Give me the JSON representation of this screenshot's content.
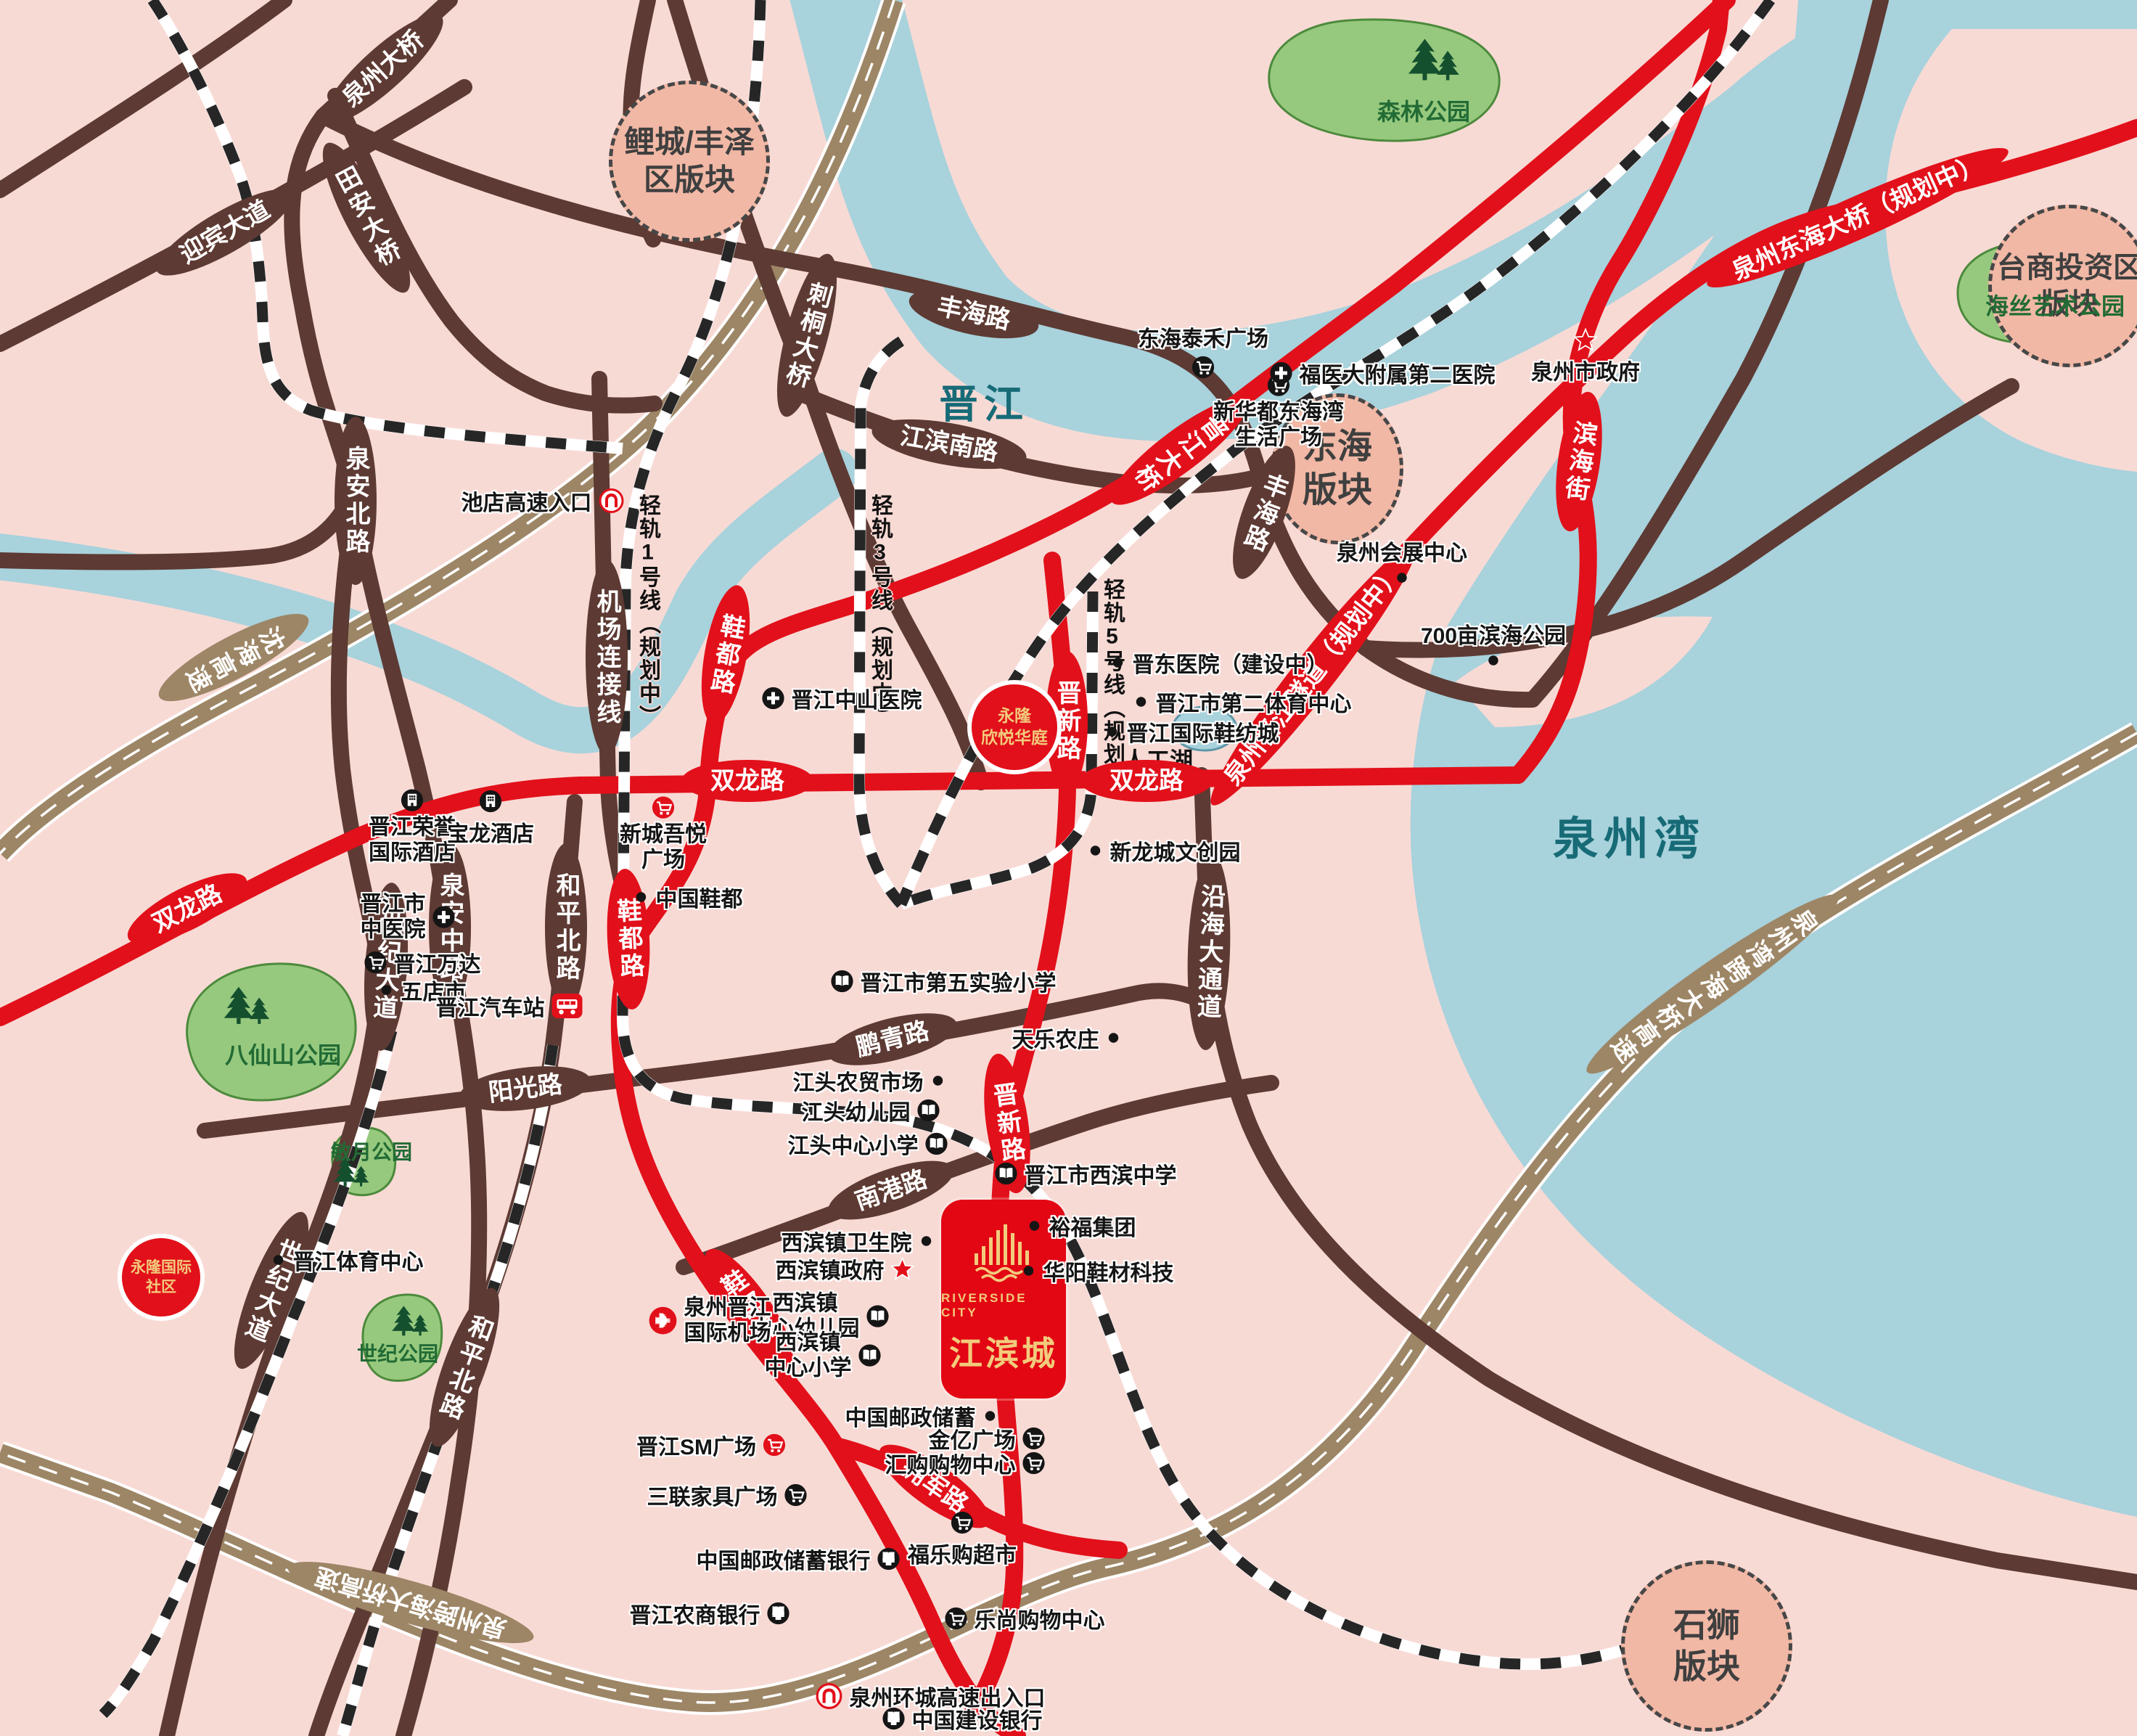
{
  "project": {
    "name_en": "RIVERSIDE CITY",
    "name_zh": "江滨城"
  },
  "colors": {
    "red": "#e2101a",
    "brown": "#5d3a33",
    "tan": "#9d8666",
    "water": "#a8d2dc",
    "background_pink": "#f8dad5",
    "zone_fill": "#f1b8a5",
    "park_fill": "#96c97e",
    "gold": "#f2cb7c"
  },
  "zones": {
    "licheng": {
      "line1": "鲤城/丰泽",
      "line2": "区版块"
    },
    "donghai": {
      "line1": "东海",
      "line2": "版块"
    },
    "taishang": {
      "line1": "台商投资区",
      "line2": "版块"
    },
    "shishi": {
      "line1": "石狮",
      "line2": "版块"
    }
  },
  "waters": {
    "jinjiang_river": "晋江",
    "quanzhou_bay": "泉州湾",
    "artificial_lake": "人工湖"
  },
  "parks": {
    "forest": "森林公园",
    "haisi_art": "海丝艺术公园",
    "baxianshan": "八仙山公园",
    "minyue": "敏月公园",
    "century": "世纪公园"
  },
  "rails": {
    "line1": "轻轨1号线（规划中）",
    "line3": "轻轨3号线（规划中）",
    "line5": "轻轨5号线（规划中）"
  },
  "roads": {
    "quanzhou_bridge": "泉州大桥",
    "tianan_bridge": "田安大桥",
    "yingbin_avenue": "迎宾大道",
    "citong_bridge": "刺桐大桥",
    "fenghai_road": "丰海路",
    "jiangbin_south_road": "江滨南路",
    "jinjiang_bridge": "晋江大桥",
    "binhai_street": "滨海街",
    "donghai_bridge": "泉州东海大桥（规划中）",
    "tunnel": "泉州晋江隧道（规划中）",
    "quanan_north_road": "泉安北路",
    "airport_link": "机场连接线",
    "shenhai_expressway": "沈海高速",
    "shuanglong_road": "双龙路",
    "xiedu_road": "鞋都路",
    "jinxin_road": "晋新路",
    "quanan_middle_road": "泉安中路",
    "heping_north_road": "和平北路",
    "century_avenue": "世纪大道",
    "yangguang_road": "阳光路",
    "pengqing_road": "鹏青路",
    "nangang_road": "南港路",
    "yanhai_avenue": "沿海大通道",
    "yongjun_road": "拥军路",
    "bay_bridge_expressway": "泉州湾跨海大桥高速",
    "cross_sea_expressway": "泉州跨海大桥高速"
  },
  "spots": {
    "yonglong_xinyue": {
      "line1": "永隆",
      "line2": "欣悦华庭"
    },
    "yonglong_intl": {
      "line1": "永隆国际",
      "line2": "社区"
    }
  },
  "pois": {
    "donghai_taihe": {
      "label": "东海泰禾广场",
      "icon": "cart-icon"
    },
    "xinhuadu": {
      "label": "新华都东海湾",
      "label2": "生活广场",
      "icon": "cart-icon"
    },
    "fuyida_hospital": {
      "label": "福医大附属第二医院",
      "icon": "hospital-icon"
    },
    "quanzhou_gov": {
      "label": "泉州市政府",
      "icon": "star-icon"
    },
    "convention_center": {
      "label": "泉州会展中心",
      "icon": "dot-icon"
    },
    "binhai_park700": {
      "label": "700亩滨海公园",
      "icon": "dot-icon"
    },
    "jindong_hospital": {
      "label": "晋东医院（建设中）",
      "icon": "dot-icon"
    },
    "second_sports": {
      "label": "晋江市第二体育中心",
      "icon": "dot-icon"
    },
    "shoe_textile_city": {
      "label": "晋江国际鞋纺城",
      "icon": "dot-icon"
    },
    "xinlongcheng": {
      "label": "新龙城文创园",
      "icon": "dot-icon"
    },
    "zhongshan_hospital": {
      "label": "晋江中山医院",
      "icon": "hospital-icon"
    },
    "rongyu_hotel": {
      "label": "晋江荣誉",
      "label2": "国际酒店",
      "icon": "hotel-icon"
    },
    "baolong_hotel": {
      "label": "宝龙酒店",
      "icon": "hotel-icon"
    },
    "wuyue_plaza": {
      "label": "新城吾悦",
      "label2": "广场",
      "icon": "cart-red-icon"
    },
    "china_shoe_capital": {
      "label": "中国鞋都",
      "icon": "dot-icon"
    },
    "tcm_hospital": {
      "label": "晋江市",
      "label2": "中医院",
      "icon": "hospital-icon"
    },
    "jinjiang_wanda": {
      "label": "晋江万达",
      "icon": "cart-icon"
    },
    "wudianshi": {
      "label": "五店市",
      "icon": "dot-icon"
    },
    "bus_station": {
      "label": "晋江汽车站",
      "icon": "bus-icon"
    },
    "sports_center": {
      "label": "晋江体育中心",
      "icon": "dot-icon"
    },
    "fifth_school": {
      "label": "晋江市第五实验小学",
      "icon": "school-icon"
    },
    "tianle_farm": {
      "label": "天乐农庄",
      "icon": "dot-icon"
    },
    "jiangtou_market": {
      "label": "江头农贸市场",
      "icon": "dot-icon"
    },
    "jiangtou_kindergarten": {
      "label": "江头幼儿园",
      "icon": "school-icon"
    },
    "jiangtou_primary": {
      "label": "江头中心小学",
      "icon": "school-icon"
    },
    "xibin_middle": {
      "label": "晋江市西滨中学",
      "icon": "school-icon"
    },
    "yufu_group": {
      "label": "裕福集团",
      "icon": "dot-icon"
    },
    "huayang_tech": {
      "label": "华阳鞋材科技",
      "icon": "dot-icon"
    },
    "xibin_clinic": {
      "label": "西滨镇卫生院",
      "icon": "dot-icon"
    },
    "xibin_gov": {
      "label": "西滨镇政府",
      "icon": "star-icon"
    },
    "xibin_kindergarten": {
      "label": "西滨镇",
      "label2": "中心幼儿园",
      "icon": "school-icon"
    },
    "xibin_primary": {
      "label": "西滨镇",
      "label2": "中心小学",
      "icon": "school-icon"
    },
    "airport": {
      "label": "泉州晋江",
      "label2": "国际机场",
      "icon": "airport-icon"
    },
    "sm_plaza": {
      "label": "晋江SM广场",
      "icon": "cart-red-icon"
    },
    "sanlian_furniture": {
      "label": "三联家具广场",
      "icon": "cart-icon"
    },
    "postal_savings": {
      "label": "中国邮政储蓄",
      "icon": "dot-icon"
    },
    "jinyi_plaza": {
      "label": "金亿广场",
      "icon": "cart-icon"
    },
    "huigou_mall": {
      "label": "汇购购物中心",
      "icon": "cart-icon"
    },
    "fulegou": {
      "label": "福乐购超市",
      "icon": "cart-icon"
    },
    "postal_bank": {
      "label": "中国邮政储蓄银行",
      "icon": "bank-icon"
    },
    "rural_bank": {
      "label": "晋江农商银行",
      "icon": "bank-icon"
    },
    "leshang_mall": {
      "label": "乐尚购物中心",
      "icon": "cart-icon"
    },
    "ring_expressway_exit": {
      "label": "泉州环城高速出入口",
      "icon": "metro-icon"
    },
    "construction_bank": {
      "label": "中国建设银行",
      "icon": "bank-icon"
    },
    "chidian_entrance": {
      "label": "池店高速入口",
      "icon": "metro-icon"
    }
  }
}
